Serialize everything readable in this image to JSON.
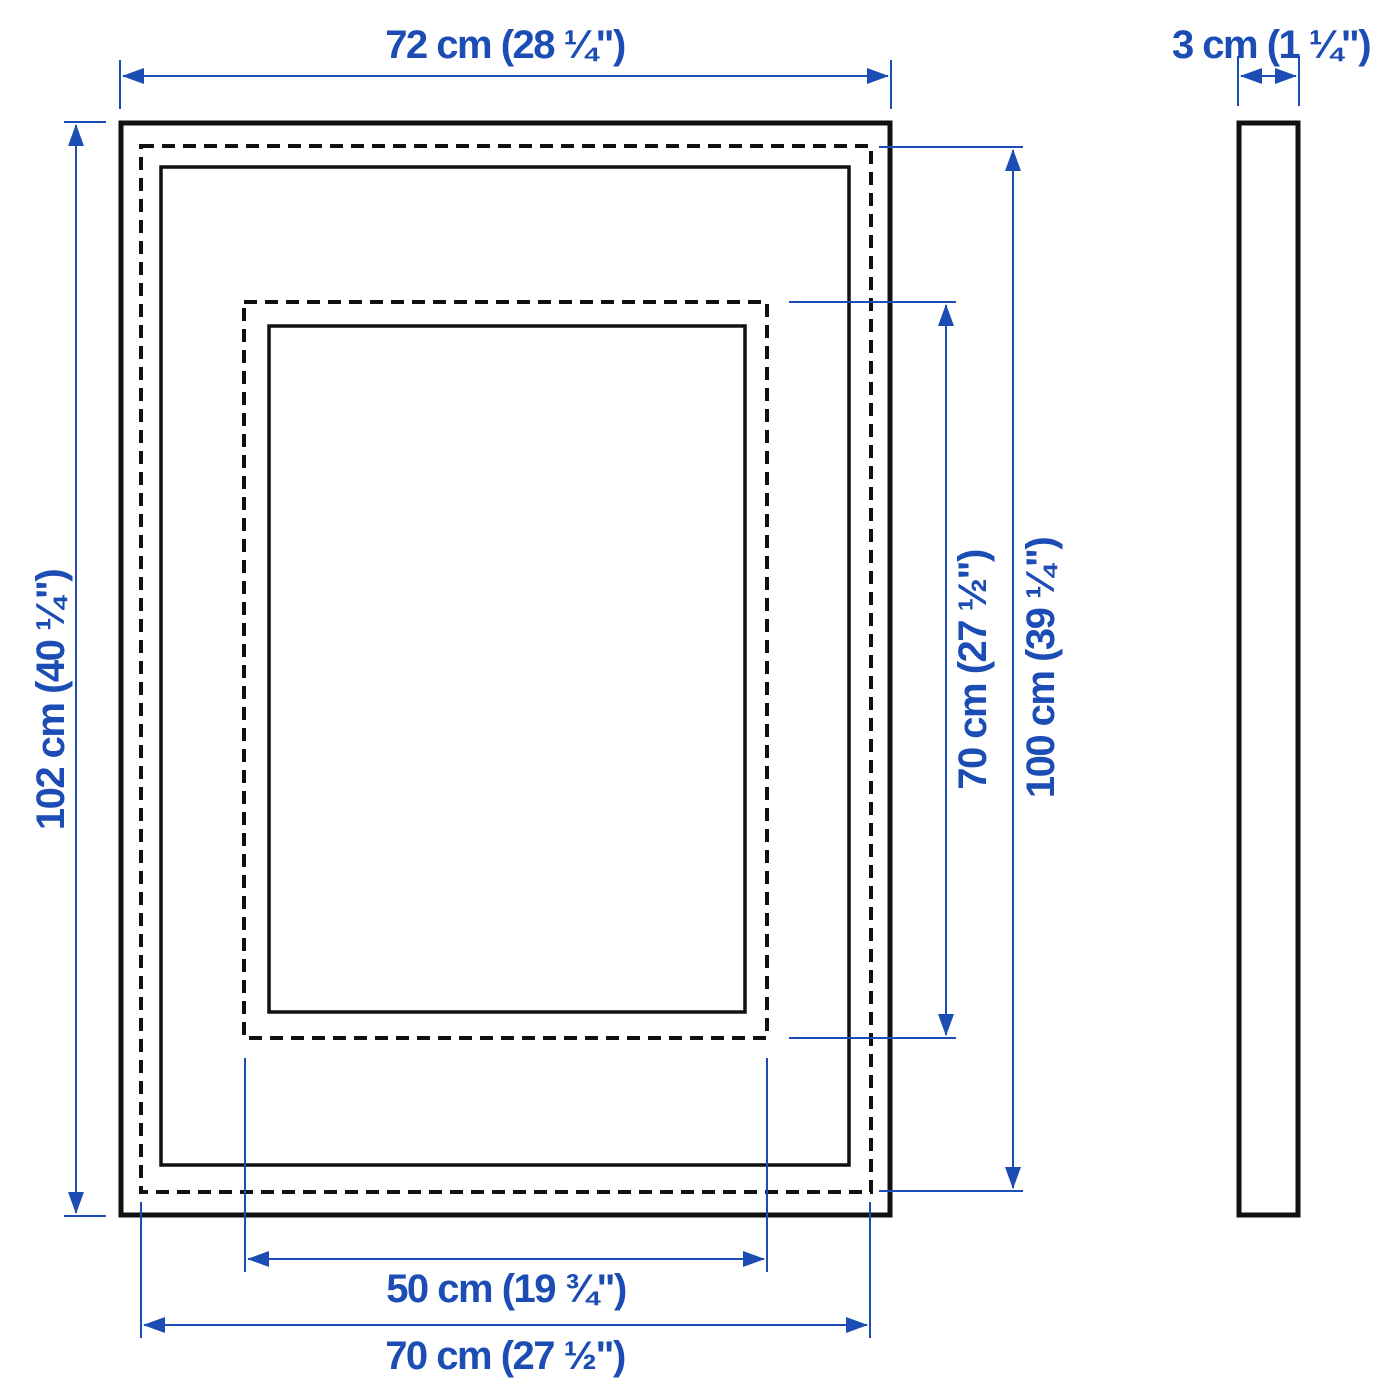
{
  "diagram": {
    "colors": {
      "dimension_accent": "#1b4db5",
      "outline": "#111111",
      "background": "#ffffff"
    }
  },
  "dimensions": {
    "frame_width": "72 cm (28 ¼\")",
    "frame_depth": "3 cm (1 ¼\")",
    "frame_height": "102 cm (40 ¼\")",
    "picture_with_mat_height": "70 cm (27 ½\")",
    "picture_without_mat_height": "100 cm (39 ¼\")",
    "picture_with_mat_width": "50 cm (19 ¾\")",
    "picture_without_mat_width": "70 cm (27 ½\")"
  }
}
